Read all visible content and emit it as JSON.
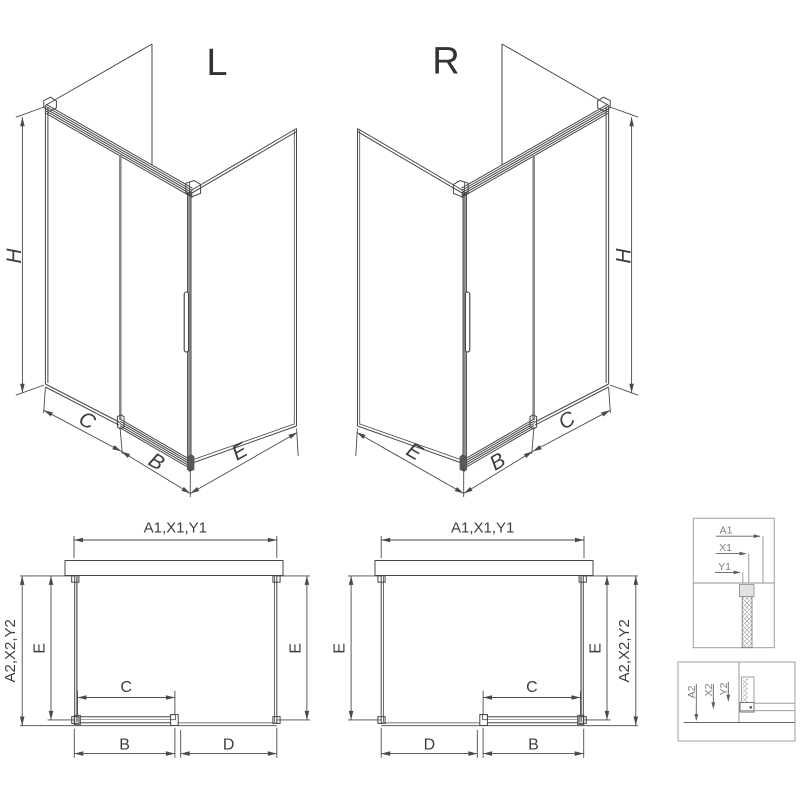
{
  "drawing_title": "shower-enclosure-dimension-drawing",
  "colors": {
    "background": "#ffffff",
    "line": "#474747",
    "dimension": "#4a4a4a",
    "glass_edge_gray": "#8a8a8a",
    "detail_gray": "#8f8f8f",
    "text": "#3d3d3d"
  },
  "iso_left": {
    "variant_label": "L",
    "dim_height": "H",
    "dim_fixed": "C",
    "dim_door": "B",
    "dim_side": "E"
  },
  "iso_right": {
    "variant_label": "R",
    "dim_height": "H",
    "dim_fixed": "C",
    "dim_door": "B",
    "dim_side": "E"
  },
  "plan_left": {
    "dim_width": "A1,X1,Y1",
    "dim_depth_total": "A2,X2,Y2",
    "dim_depth_left": "E",
    "dim_depth_right": "E",
    "dim_opening": "C",
    "dim_door": "B",
    "dim_fixed": "D"
  },
  "plan_right": {
    "dim_width": "A1,X1,Y1",
    "dim_depth_total": "A2,X2,Y2",
    "dim_depth_left": "E",
    "dim_depth_right": "E",
    "dim_opening": "C",
    "dim_door": "B",
    "dim_fixed": "D"
  },
  "detail_wall": {
    "dim_a": "A1",
    "dim_x": "X1",
    "dim_y": "Y1"
  },
  "detail_floor": {
    "dim_a": "A2",
    "dim_x": "X2",
    "dim_y": "Y2"
  }
}
